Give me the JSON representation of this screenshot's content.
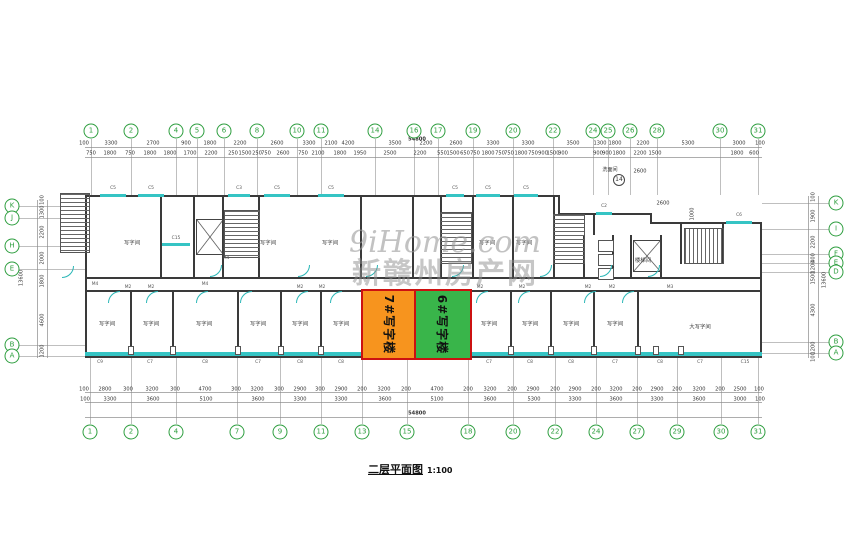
{
  "caption": {
    "title": "二层平面图",
    "scale": "1:100"
  },
  "watermark": {
    "line1": "9iHome.com",
    "line2": "新赣州房产网"
  },
  "totals": {
    "top": "54800",
    "bottom": "54800",
    "left": "13600",
    "right": "13600"
  },
  "highlight_blocks": [
    {
      "label": "7#写字楼",
      "color": "#F7941E",
      "x": 361,
      "y": 289,
      "w": 53,
      "h": 67
    },
    {
      "label": "6#写字楼",
      "color": "#39B54A",
      "x": 414,
      "y": 289,
      "w": 54,
      "h": 67
    }
  ],
  "colors": {
    "window": "#35c4c4",
    "bubble_green": "#2e9e3f",
    "highlight_border": "#cc1111"
  },
  "axes": {
    "top_bubbles": [
      {
        "n": "1",
        "x": 91
      },
      {
        "n": "2",
        "x": 131
      },
      {
        "n": "4",
        "x": 176
      },
      {
        "n": "5",
        "x": 197
      },
      {
        "n": "6",
        "x": 224
      },
      {
        "n": "8",
        "x": 257
      },
      {
        "n": "10",
        "x": 297
      },
      {
        "n": "11",
        "x": 321
      },
      {
        "n": "14",
        "x": 375
      },
      {
        "n": "16",
        "x": 414
      },
      {
        "n": "17",
        "x": 438
      },
      {
        "n": "19",
        "x": 473
      },
      {
        "n": "20",
        "x": 513
      },
      {
        "n": "22",
        "x": 553
      },
      {
        "n": "24",
        "x": 593
      },
      {
        "n": "25",
        "x": 608
      },
      {
        "n": "26",
        "x": 630
      },
      {
        "n": "28",
        "x": 657
      },
      {
        "n": "30",
        "x": 720
      },
      {
        "n": "31",
        "x": 758
      }
    ],
    "top_dims1": [
      {
        "v": "100",
        "x": 84
      },
      {
        "v": "3300",
        "x": 111
      },
      {
        "v": "2700",
        "x": 153
      },
      {
        "v": "900",
        "x": 186
      },
      {
        "v": "1800",
        "x": 210
      },
      {
        "v": "2200",
        "x": 240
      },
      {
        "v": "2600",
        "x": 277
      },
      {
        "v": "3300",
        "x": 309
      },
      {
        "v": "2100",
        "x": 331
      },
      {
        "v": "4200",
        "x": 348
      },
      {
        "v": "3500",
        "x": 395
      },
      {
        "v": "2200",
        "x": 426
      },
      {
        "v": "2600",
        "x": 456
      },
      {
        "v": "3300",
        "x": 493
      },
      {
        "v": "3300",
        "x": 528
      },
      {
        "v": "3500",
        "x": 573
      },
      {
        "v": "1300",
        "x": 600
      },
      {
        "v": "1800",
        "x": 615
      },
      {
        "v": "2200",
        "x": 643
      },
      {
        "v": "5300",
        "x": 688
      },
      {
        "v": "3000",
        "x": 739
      },
      {
        "v": "100",
        "x": 760
      }
    ],
    "top_dims2": [
      {
        "v": "750",
        "x": 91
      },
      {
        "v": "1800",
        "x": 110
      },
      {
        "v": "750",
        "x": 130
      },
      {
        "v": "1800",
        "x": 150
      },
      {
        "v": "1800",
        "x": 170
      },
      {
        "v": "1700",
        "x": 190
      },
      {
        "v": "2200",
        "x": 211
      },
      {
        "v": "250",
        "x": 233
      },
      {
        "v": "1500",
        "x": 245
      },
      {
        "v": "250",
        "x": 257
      },
      {
        "v": "750",
        "x": 266
      },
      {
        "v": "2600",
        "x": 283
      },
      {
        "v": "750",
        "x": 303
      },
      {
        "v": "2100",
        "x": 318
      },
      {
        "v": "1800",
        "x": 340
      },
      {
        "v": "1950",
        "x": 360
      },
      {
        "v": "2500",
        "x": 390
      },
      {
        "v": "2200",
        "x": 420
      },
      {
        "v": "550",
        "x": 442
      },
      {
        "v": "1500",
        "x": 453
      },
      {
        "v": "650",
        "x": 465
      },
      {
        "v": "750",
        "x": 475
      },
      {
        "v": "1800",
        "x": 488
      },
      {
        "v": "750",
        "x": 500
      },
      {
        "v": "750",
        "x": 509
      },
      {
        "v": "1800",
        "x": 521
      },
      {
        "v": "750",
        "x": 533
      },
      {
        "v": "900",
        "x": 543
      },
      {
        "v": "1500",
        "x": 553
      },
      {
        "v": "900",
        "x": 563
      },
      {
        "v": "900",
        "x": 598
      },
      {
        "v": "900",
        "x": 607
      },
      {
        "v": "1800",
        "x": 619
      },
      {
        "v": "2200",
        "x": 640
      },
      {
        "v": "1500",
        "x": 655
      },
      {
        "v": "1800",
        "x": 737
      },
      {
        "v": "600",
        "x": 754
      }
    ],
    "bottom_bubbles": [
      {
        "n": "1",
        "x": 90
      },
      {
        "n": "2",
        "x": 131
      },
      {
        "n": "4",
        "x": 176
      },
      {
        "n": "7",
        "x": 237
      },
      {
        "n": "9",
        "x": 280
      },
      {
        "n": "11",
        "x": 321
      },
      {
        "n": "13",
        "x": 362
      },
      {
        "n": "15",
        "x": 407
      },
      {
        "n": "18",
        "x": 468
      },
      {
        "n": "20",
        "x": 513
      },
      {
        "n": "22",
        "x": 555
      },
      {
        "n": "24",
        "x": 596
      },
      {
        "n": "27",
        "x": 637
      },
      {
        "n": "29",
        "x": 677
      },
      {
        "n": "30",
        "x": 721
      },
      {
        "n": "31",
        "x": 758
      }
    ],
    "bottom_dims1": [
      {
        "v": "100",
        "x": 84
      },
      {
        "v": "2800",
        "x": 105
      },
      {
        "v": "300",
        "x": 128
      },
      {
        "v": "3200",
        "x": 152
      },
      {
        "v": "300",
        "x": 175
      },
      {
        "v": "4700",
        "x": 205
      },
      {
        "v": "300",
        "x": 236
      },
      {
        "v": "3200",
        "x": 257
      },
      {
        "v": "300",
        "x": 279
      },
      {
        "v": "2900",
        "x": 300
      },
      {
        "v": "300",
        "x": 320
      },
      {
        "v": "2900",
        "x": 341
      },
      {
        "v": "200",
        "x": 362
      },
      {
        "v": "3200",
        "x": 384
      },
      {
        "v": "200",
        "x": 406
      },
      {
        "v": "4700",
        "x": 437
      },
      {
        "v": "200",
        "x": 468
      },
      {
        "v": "3200",
        "x": 490
      },
      {
        "v": "200",
        "x": 512
      },
      {
        "v": "2900",
        "x": 533
      },
      {
        "v": "200",
        "x": 555
      },
      {
        "v": "2900",
        "x": 575
      },
      {
        "v": "200",
        "x": 596
      },
      {
        "v": "3200",
        "x": 616
      },
      {
        "v": "200",
        "x": 637
      },
      {
        "v": "2900",
        "x": 657
      },
      {
        "v": "200",
        "x": 677
      },
      {
        "v": "3200",
        "x": 699
      },
      {
        "v": "200",
        "x": 720
      },
      {
        "v": "2500",
        "x": 740
      },
      {
        "v": "100",
        "x": 759
      }
    ],
    "bottom_dims2": [
      {
        "v": "100",
        "x": 85
      },
      {
        "v": "3300",
        "x": 110
      },
      {
        "v": "3600",
        "x": 153
      },
      {
        "v": "5100",
        "x": 206
      },
      {
        "v": "3600",
        "x": 258
      },
      {
        "v": "3300",
        "x": 300
      },
      {
        "v": "3300",
        "x": 341
      },
      {
        "v": "3600",
        "x": 385
      },
      {
        "v": "5100",
        "x": 437
      },
      {
        "v": "3600",
        "x": 490
      },
      {
        "v": "5300",
        "x": 534
      },
      {
        "v": "3300",
        "x": 575
      },
      {
        "v": "3600",
        "x": 616
      },
      {
        "v": "3300",
        "x": 657
      },
      {
        "v": "3600",
        "x": 699
      },
      {
        "v": "3000",
        "x": 740
      },
      {
        "v": "100",
        "x": 760
      }
    ],
    "left_bubbles": [
      {
        "n": "K",
        "y": 206
      },
      {
        "n": "J",
        "y": 218
      },
      {
        "n": "H",
        "y": 246
      },
      {
        "n": "E",
        "y": 269
      },
      {
        "n": "B",
        "y": 345
      },
      {
        "n": "A",
        "y": 356
      }
    ],
    "left_dims": [
      {
        "v": "100",
        "y": 200
      },
      {
        "v": "1300",
        "y": 212
      },
      {
        "v": "2200",
        "y": 232
      },
      {
        "v": "2000",
        "y": 258
      },
      {
        "v": "1800",
        "y": 281
      },
      {
        "v": "4600",
        "y": 320
      },
      {
        "v": "1200",
        "y": 351
      }
    ],
    "right_bubbles": [
      {
        "n": "K",
        "y": 203
      },
      {
        "n": "I",
        "y": 229
      },
      {
        "n": "F",
        "y": 254
      },
      {
        "n": "E",
        "y": 263
      },
      {
        "n": "D",
        "y": 272
      },
      {
        "n": "B",
        "y": 342
      },
      {
        "n": "A",
        "y": 353
      }
    ],
    "right_dims": [
      {
        "v": "100",
        "y": 197
      },
      {
        "v": "1900",
        "y": 216
      },
      {
        "v": "2200",
        "y": 242
      },
      {
        "v": "400",
        "y": 258
      },
      {
        "v": "1200",
        "y": 267
      },
      {
        "v": "1500",
        "y": 278
      },
      {
        "v": "4300",
        "y": 310
      },
      {
        "v": "1200",
        "y": 348
      },
      {
        "v": "100",
        "y": 357
      }
    ]
  },
  "plan": {
    "rooms": [
      {
        "label": "写字间",
        "x": 132,
        "y": 242
      },
      {
        "label": "写字间",
        "x": 268,
        "y": 242
      },
      {
        "label": "写字间",
        "x": 330,
        "y": 242
      },
      {
        "label": "写字间",
        "x": 487,
        "y": 242
      },
      {
        "label": "写字间",
        "x": 524,
        "y": 242
      },
      {
        "label": "写字间",
        "x": 107,
        "y": 323
      },
      {
        "label": "写字间",
        "x": 151,
        "y": 323
      },
      {
        "label": "写字间",
        "x": 204,
        "y": 323
      },
      {
        "label": "写字间",
        "x": 258,
        "y": 323
      },
      {
        "label": "写字间",
        "x": 300,
        "y": 323
      },
      {
        "label": "写字间",
        "x": 341,
        "y": 323
      },
      {
        "label": "写字间",
        "x": 489,
        "y": 323
      },
      {
        "label": "写字间",
        "x": 530,
        "y": 323
      },
      {
        "label": "写字间",
        "x": 571,
        "y": 323
      },
      {
        "label": "写字间",
        "x": 615,
        "y": 323
      },
      {
        "label": "大写字间",
        "x": 700,
        "y": 326
      },
      {
        "label": "楼梯间",
        "x": 643,
        "y": 260
      }
    ],
    "top_windows": [
      {
        "label": "C5",
        "x": 100,
        "w": 26,
        "y": 194
      },
      {
        "label": "C5",
        "x": 138,
        "w": 26,
        "y": 194
      },
      {
        "label": "C3",
        "x": 228,
        "w": 22,
        "y": 194
      },
      {
        "label": "C5",
        "x": 264,
        "w": 26,
        "y": 194
      },
      {
        "label": "C5",
        "x": 318,
        "w": 26,
        "y": 194
      },
      {
        "label": "C5",
        "x": 446,
        "w": 18,
        "y": 194
      },
      {
        "label": "C5",
        "x": 476,
        "w": 24,
        "y": 194
      },
      {
        "label": "C5",
        "x": 514,
        "w": 24,
        "y": 194
      },
      {
        "label": "C2",
        "x": 596,
        "w": 16,
        "y": 212
      },
      {
        "label": "C6",
        "x": 726,
        "w": 26,
        "y": 221
      }
    ],
    "bottom_windows": [
      {
        "label": "C9",
        "x": 100
      },
      {
        "label": "C7",
        "x": 150
      },
      {
        "label": "C8",
        "x": 205
      },
      {
        "label": "C7",
        "x": 258
      },
      {
        "label": "C8",
        "x": 300
      },
      {
        "label": "C8",
        "x": 341
      },
      {
        "label": "C7",
        "x": 489
      },
      {
        "label": "C8",
        "x": 530
      },
      {
        "label": "C8",
        "x": 571
      },
      {
        "label": "C7",
        "x": 615
      },
      {
        "label": "C8",
        "x": 660
      },
      {
        "label": "C7",
        "x": 700
      },
      {
        "label": "C15",
        "x": 745
      }
    ],
    "interior_window": {
      "label": "C15",
      "x": 162,
      "y": 243,
      "w": 28
    },
    "door_labels": [
      {
        "t": "M4",
        "x": 95,
        "y": 284
      },
      {
        "t": "M2",
        "x": 128,
        "y": 287
      },
      {
        "t": "M2",
        "x": 151,
        "y": 287
      },
      {
        "t": "M4",
        "x": 205,
        "y": 284
      },
      {
        "t": "M2",
        "x": 300,
        "y": 287
      },
      {
        "t": "M2",
        "x": 322,
        "y": 287
      },
      {
        "t": "M2",
        "x": 480,
        "y": 287
      },
      {
        "t": "M2",
        "x": 522,
        "y": 287
      },
      {
        "t": "M2",
        "x": 588,
        "y": 287
      },
      {
        "t": "M2",
        "x": 612,
        "y": 287
      },
      {
        "t": "M4",
        "x": 226,
        "y": 258
      },
      {
        "t": "M3",
        "x": 670,
        "y": 287
      }
    ],
    "annotations": [
      {
        "t": "2600",
        "x": 640,
        "y": 171,
        "vert": false
      },
      {
        "t": "洗面间",
        "x": 610,
        "y": 169,
        "vert": false
      },
      {
        "t": "2600",
        "x": 663,
        "y": 203,
        "vert": false
      },
      {
        "t": "1000",
        "x": 692,
        "y": 214,
        "vert": true
      }
    ],
    "detail_bubble": {
      "n": "14",
      "x": 619,
      "y": 180
    }
  }
}
